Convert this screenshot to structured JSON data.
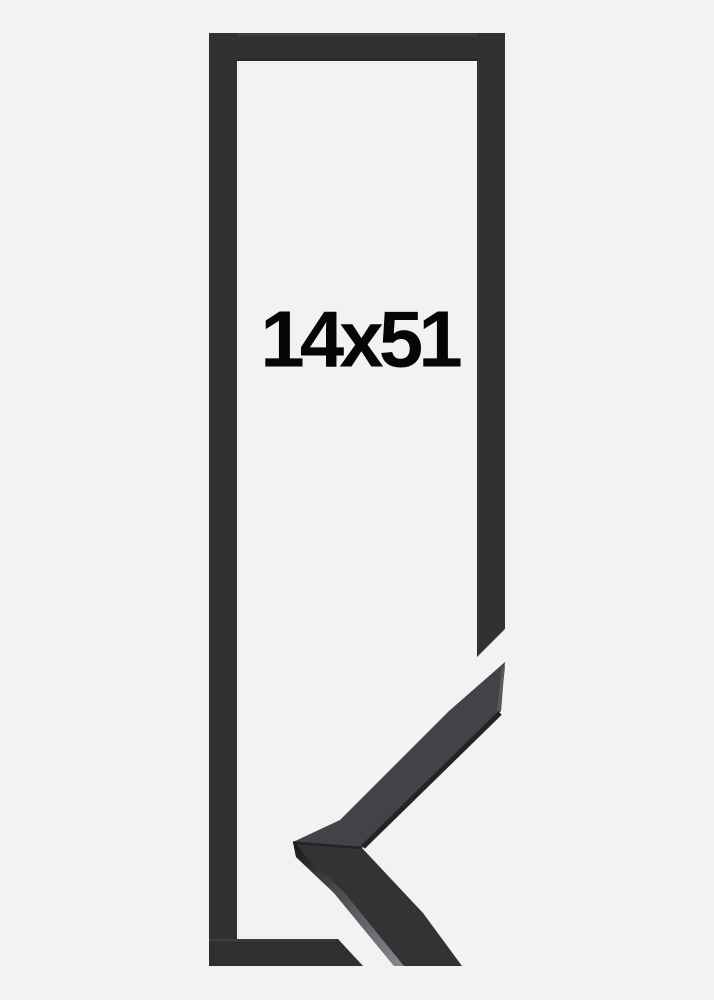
{
  "product": {
    "size_label": "14x51"
  },
  "colors": {
    "background": "#f2f2f3",
    "frame_outline": "#313134",
    "frame_outline_bottom": "#2f2f32",
    "moulding_upper_face": "#434347",
    "moulding_lower_face": "#333336",
    "moulding_edge_shadow": "#232326",
    "text": "#060606"
  }
}
